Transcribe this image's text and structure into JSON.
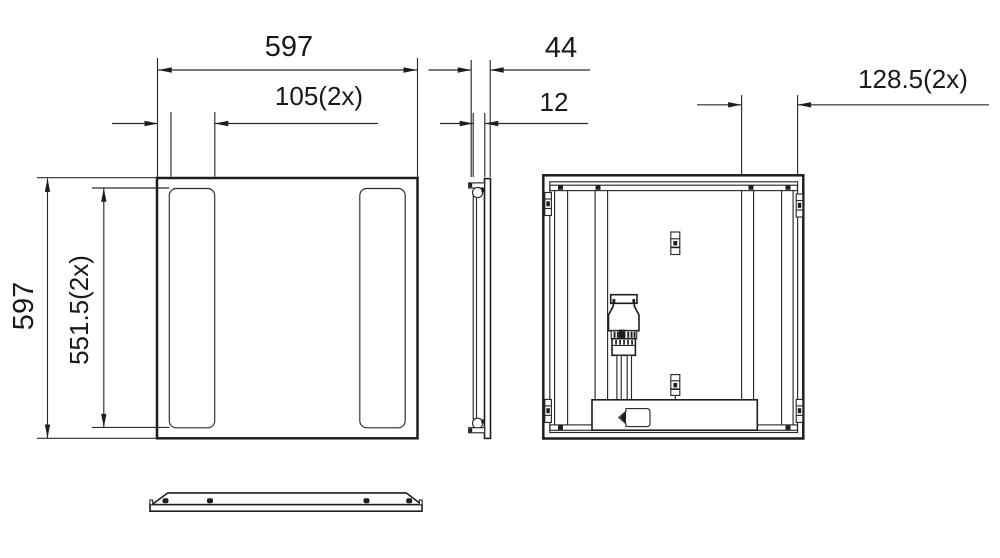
{
  "drawing": {
    "background": "#ffffff",
    "line_color": "#1e1e1e",
    "dimensions": {
      "panel_width": "597",
      "slot_width": "105(2x)",
      "panel_height": "597",
      "slot_length": "551.5(2x)",
      "depth": "44",
      "face_thickness": "12",
      "connector_offset": "128.5(2x)"
    }
  }
}
